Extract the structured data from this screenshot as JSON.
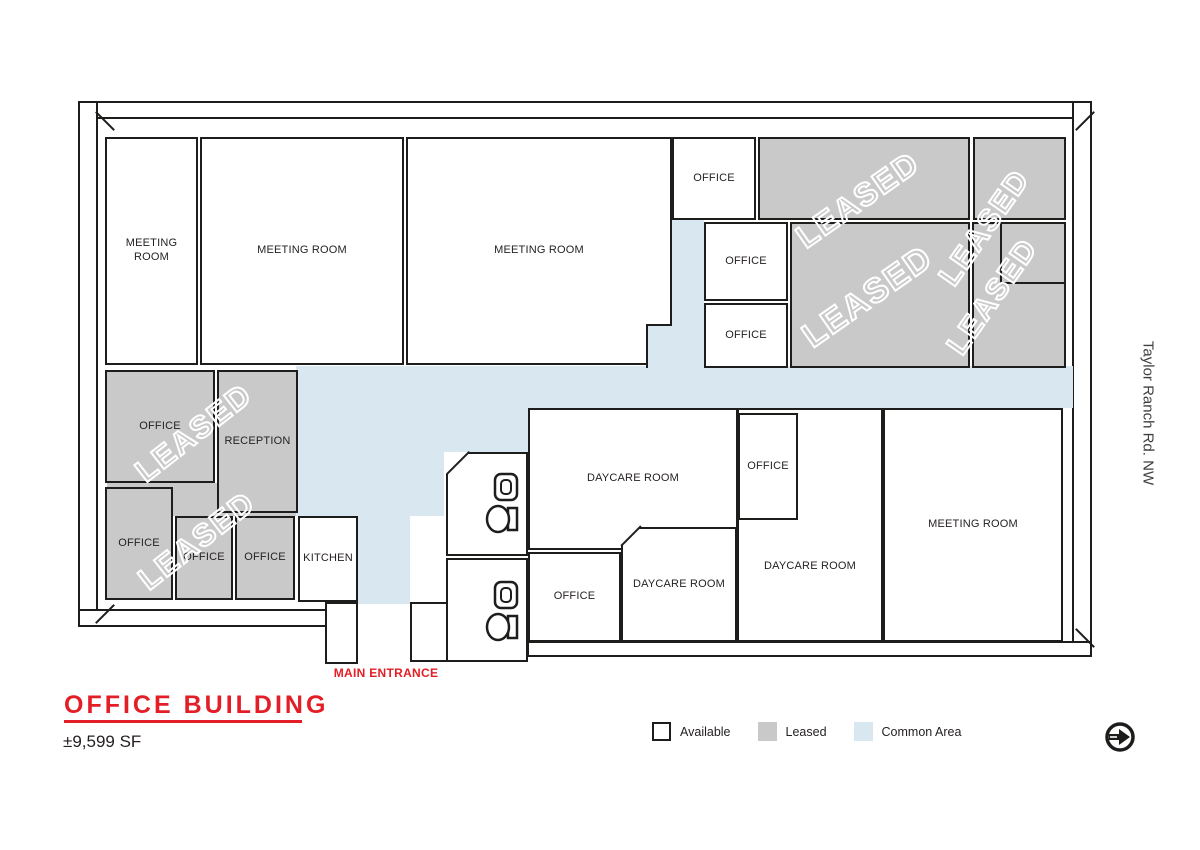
{
  "title_block": {
    "title": "OFFICE BUILDING",
    "area": "±9,599 SF"
  },
  "entrance": {
    "label": "MAIN ENTRANCE"
  },
  "street": {
    "label": "Taylor Ranch Rd. NW"
  },
  "labels": {
    "leased_watermark": "LEASED"
  },
  "legend": {
    "items": [
      {
        "label": "Available",
        "swatch": "available"
      },
      {
        "label": "Leased",
        "swatch": "leased"
      },
      {
        "label": "Common Area",
        "swatch": "common"
      }
    ]
  },
  "rooms": [
    {
      "name": "meeting-room-1",
      "label": "MEETING ROOM",
      "status": "available"
    },
    {
      "name": "meeting-room-2",
      "label": "MEETING ROOM",
      "status": "available"
    },
    {
      "name": "meeting-room-3",
      "label": "MEETING ROOM",
      "status": "available"
    },
    {
      "name": "office-top",
      "label": "OFFICE",
      "status": "available"
    },
    {
      "name": "office-mid",
      "label": "OFFICE",
      "status": "available"
    },
    {
      "name": "office-low",
      "label": "OFFICE",
      "status": "available"
    },
    {
      "name": "office-leased-west",
      "label": "OFFICE",
      "status": "leased"
    },
    {
      "name": "reception",
      "label": "RECEPTION",
      "status": "leased"
    },
    {
      "name": "office-leased-sw1",
      "label": "OFFICE",
      "status": "leased"
    },
    {
      "name": "office-leased-sw2",
      "label": "OFFICE",
      "status": "leased"
    },
    {
      "name": "office-leased-sw3",
      "label": "OFFICE",
      "status": "leased"
    },
    {
      "name": "kitchen",
      "label": "KITCHEN",
      "status": "available"
    },
    {
      "name": "daycare-room-north",
      "label": "DAYCARE ROOM",
      "status": "available"
    },
    {
      "name": "office-daycare-east",
      "label": "OFFICE",
      "status": "available"
    },
    {
      "name": "office-daycare-south",
      "label": "OFFICE",
      "status": "available"
    },
    {
      "name": "daycare-room-south",
      "label": "DAYCARE ROOM",
      "status": "available"
    },
    {
      "name": "daycare-room-east",
      "label": "DAYCARE ROOM",
      "status": "available"
    },
    {
      "name": "meeting-room-4",
      "label": "MEETING ROOM",
      "status": "available"
    }
  ],
  "colors": {
    "wall": "#1d1d1b",
    "leased_fill": "#c9c9c9",
    "common_fill": "#d9e8f0",
    "accent_red": "#e31e26",
    "label_text": "#231f20"
  }
}
